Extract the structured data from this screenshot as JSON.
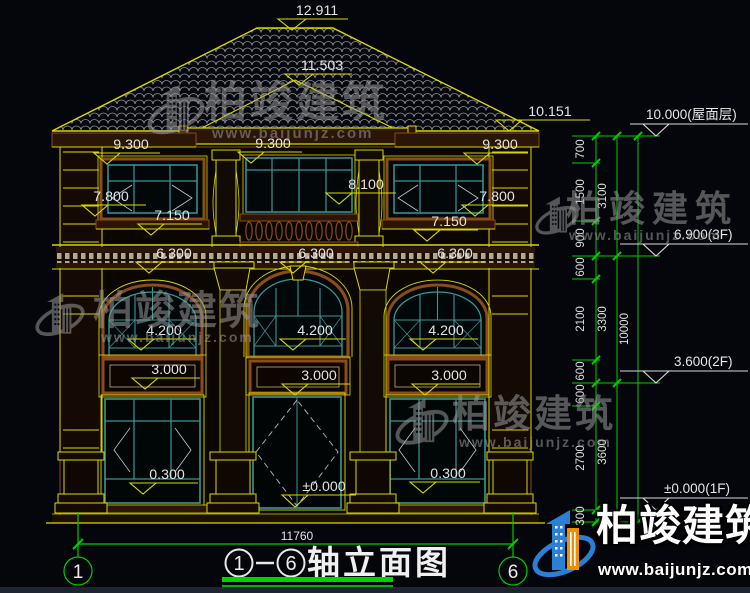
{
  "dims": {
    "peak": "12.911",
    "ridge2": "11.503",
    "eave": "10.151",
    "lv9300": [
      "9.300",
      "9.300",
      "9.300"
    ],
    "lv7800": [
      "7.800",
      "7.800"
    ],
    "lv8100": "8.100",
    "lv7150": [
      "7.150",
      "7.150"
    ],
    "lv6300": [
      "6.300",
      "6.300",
      "6.300"
    ],
    "lv4200": [
      "4.200",
      "4.200",
      "4.200"
    ],
    "lv3000": [
      "3.000",
      "3.000",
      "3.000"
    ],
    "lv0300": [
      "0.300",
      "0.300"
    ],
    "lv0000": "±0.000",
    "width_total": "11760"
  },
  "markers": [
    {
      "label": "10.000(屋面层)"
    },
    {
      "label": "6.900(3F)"
    },
    {
      "label": "3.600(2F)"
    },
    {
      "label": "±0.000(1F)"
    }
  ],
  "chain": {
    "small": [
      "700",
      "1500",
      "900",
      "600",
      "2100",
      "600",
      "600",
      "2700",
      "300"
    ],
    "mid": [
      "3100",
      "3300",
      "3600"
    ],
    "total": "10000"
  },
  "axes": {
    "start": "1",
    "end": "6"
  },
  "title": {
    "name": "轴立面图",
    "from_axis": "1",
    "to_axis": "6",
    "separator": "-"
  },
  "watermark": {
    "brand": "柏竣建筑",
    "url": "www.baijunjz.com"
  },
  "sitelogo": {
    "brand": "柏竣建筑",
    "url": "www.baijunjz.com"
  }
}
